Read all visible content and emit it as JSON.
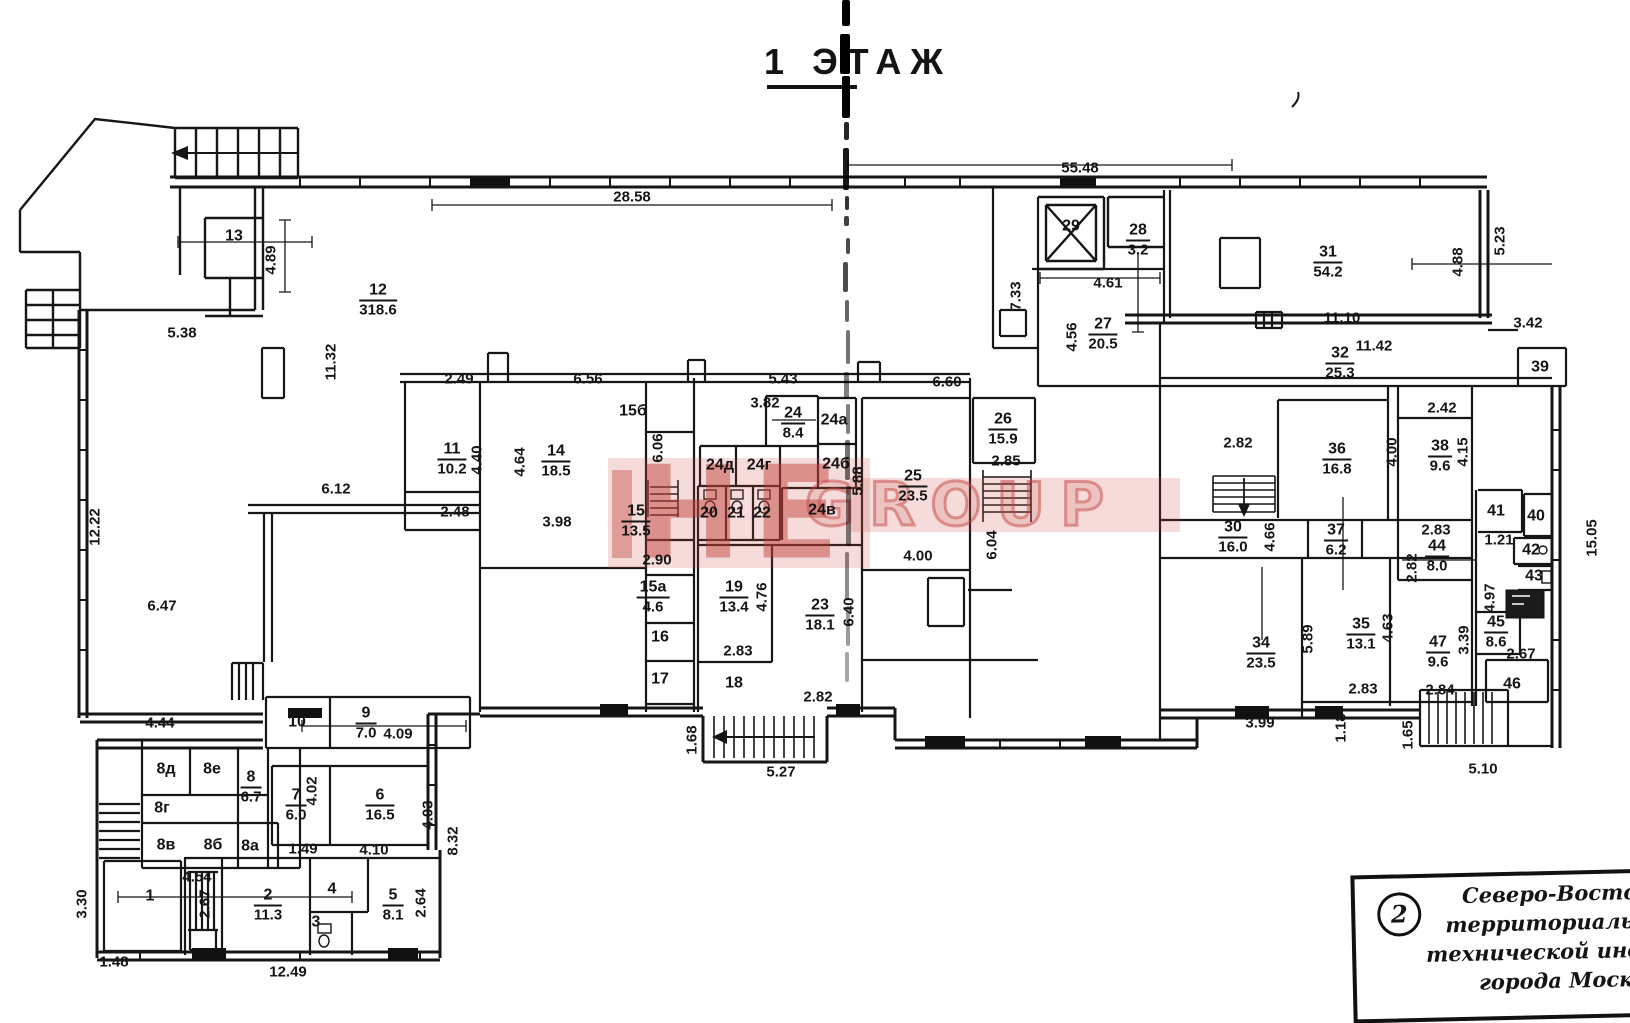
{
  "title": {
    "floor": "1 ЭТАЖ"
  },
  "watermark": {
    "left": "НЕ",
    "right": "GROUP",
    "color": "#c24b44"
  },
  "rooms": [
    {
      "n": "12",
      "a": "318.6",
      "x": 378,
      "y": 300
    },
    {
      "n": "11",
      "a": "10.2",
      "x": 452,
      "y": 459
    },
    {
      "n": "14",
      "a": "18.5",
      "x": 556,
      "y": 461
    },
    {
      "n": "15",
      "a": "13.5",
      "x": 636,
      "y": 521
    },
    {
      "n": "15а",
      "a": "4.6",
      "x": 653,
      "y": 597
    },
    {
      "n": "19",
      "a": "13.4",
      "x": 734,
      "y": 597
    },
    {
      "n": "23",
      "a": "18.1",
      "x": 820,
      "y": 615
    },
    {
      "n": "24",
      "a": "8.4",
      "x": 793,
      "y": 423
    },
    {
      "n": "25",
      "a": "23.5",
      "x": 913,
      "y": 486
    },
    {
      "n": "26",
      "a": "15.9",
      "x": 1003,
      "y": 429
    },
    {
      "n": "27",
      "a": "20.5",
      "x": 1103,
      "y": 334
    },
    {
      "n": "28",
      "a": "3.2",
      "x": 1138,
      "y": 240
    },
    {
      "n": "31",
      "a": "54.2",
      "x": 1328,
      "y": 262
    },
    {
      "n": "32",
      "a": "25.3",
      "x": 1340,
      "y": 363
    },
    {
      "n": "36",
      "a": "16.8",
      "x": 1337,
      "y": 459
    },
    {
      "n": "38",
      "a": "9.6",
      "x": 1440,
      "y": 456
    },
    {
      "n": "30",
      "a": "16.0",
      "x": 1233,
      "y": 537
    },
    {
      "n": "37",
      "a": "6.2",
      "x": 1336,
      "y": 540
    },
    {
      "n": "34",
      "a": "23.5",
      "x": 1261,
      "y": 653
    },
    {
      "n": "35",
      "a": "13.1",
      "x": 1361,
      "y": 634
    },
    {
      "n": "44",
      "a": "8.0",
      "x": 1437,
      "y": 556
    },
    {
      "n": "47",
      "a": "9.6",
      "x": 1438,
      "y": 652
    },
    {
      "n": "45",
      "a": "8.6",
      "x": 1496,
      "y": 632
    },
    {
      "n": "9",
      "a": "7.0",
      "x": 366,
      "y": 723
    },
    {
      "n": "8",
      "a": "6.7",
      "x": 251,
      "y": 787
    },
    {
      "n": "7",
      "a": "6.0",
      "x": 296,
      "y": 805
    },
    {
      "n": "6",
      "a": "16.5",
      "x": 380,
      "y": 805
    },
    {
      "n": "2",
      "a": "11.3",
      "x": 268,
      "y": 905
    },
    {
      "n": "5",
      "a": "8.1",
      "x": 393,
      "y": 905
    },
    {
      "n": "13",
      "x": 234,
      "y": 236
    },
    {
      "n": "29",
      "x": 1071,
      "y": 226
    },
    {
      "n": "15б",
      "x": 633,
      "y": 411
    },
    {
      "n": "20",
      "x": 709,
      "y": 513
    },
    {
      "n": "21",
      "x": 736,
      "y": 513
    },
    {
      "n": "22",
      "x": 762,
      "y": 513
    },
    {
      "n": "24д",
      "x": 720,
      "y": 465
    },
    {
      "n": "24г",
      "x": 759,
      "y": 465
    },
    {
      "n": "24а",
      "x": 834,
      "y": 420
    },
    {
      "n": "24б",
      "x": 836,
      "y": 464
    },
    {
      "n": "24в",
      "x": 822,
      "y": 510
    },
    {
      "n": "10",
      "x": 297,
      "y": 722
    },
    {
      "n": "16",
      "x": 660,
      "y": 637
    },
    {
      "n": "17",
      "x": 660,
      "y": 679
    },
    {
      "n": "18",
      "x": 734,
      "y": 683
    },
    {
      "n": "8д",
      "x": 166,
      "y": 769
    },
    {
      "n": "8е",
      "x": 212,
      "y": 769
    },
    {
      "n": "8г",
      "x": 162,
      "y": 808
    },
    {
      "n": "8в",
      "x": 166,
      "y": 845
    },
    {
      "n": "8б",
      "x": 213,
      "y": 845
    },
    {
      "n": "8а",
      "x": 250,
      "y": 846
    },
    {
      "n": "1",
      "x": 150,
      "y": 896
    },
    {
      "n": "3",
      "x": 316,
      "y": 922
    },
    {
      "n": "4",
      "x": 332,
      "y": 889
    },
    {
      "n": "39",
      "x": 1540,
      "y": 367
    },
    {
      "n": "41",
      "x": 1496,
      "y": 511
    },
    {
      "n": "40",
      "x": 1536,
      "y": 516
    },
    {
      "n": "42",
      "x": 1531,
      "y": 550
    },
    {
      "n": "43",
      "x": 1534,
      "y": 576
    },
    {
      "n": "46",
      "x": 1512,
      "y": 684
    }
  ],
  "dims": [
    {
      "t": "28.58",
      "x": 632,
      "y": 197
    },
    {
      "t": "55.48",
      "x": 1080,
      "y": 168
    },
    {
      "t": "5.38",
      "x": 182,
      "y": 333
    },
    {
      "t": "4.89",
      "x": 271,
      "y": 260,
      "r": -90
    },
    {
      "t": "11.32",
      "x": 331,
      "y": 362,
      "r": -90
    },
    {
      "t": "12.22",
      "x": 95,
      "y": 527,
      "r": -90
    },
    {
      "t": "6.12",
      "x": 336,
      "y": 489
    },
    {
      "t": "6.47",
      "x": 162,
      "y": 606
    },
    {
      "t": "4.44",
      "x": 160,
      "y": 723
    },
    {
      "t": "2.49",
      "x": 459,
      "y": 379
    },
    {
      "t": "6.56",
      "x": 588,
      "y": 379
    },
    {
      "t": "5.43",
      "x": 783,
      "y": 379
    },
    {
      "t": "3.82",
      "x": 765,
      "y": 403
    },
    {
      "t": "6.60",
      "x": 947,
      "y": 382
    },
    {
      "t": "4.40",
      "x": 477,
      "y": 460,
      "r": -90
    },
    {
      "t": "4.64",
      "x": 520,
      "y": 462,
      "r": -90
    },
    {
      "t": "2.48",
      "x": 455,
      "y": 512
    },
    {
      "t": "3.98",
      "x": 557,
      "y": 522
    },
    {
      "t": "6.06",
      "x": 658,
      "y": 448,
      "r": -90
    },
    {
      "t": "2.90",
      "x": 657,
      "y": 560
    },
    {
      "t": "4.76",
      "x": 762,
      "y": 597,
      "r": -90
    },
    {
      "t": "6.40",
      "x": 849,
      "y": 612,
      "r": -90
    },
    {
      "t": "2.83",
      "x": 738,
      "y": 651
    },
    {
      "t": "2.82",
      "x": 818,
      "y": 697
    },
    {
      "t": "1.68",
      "x": 692,
      "y": 740,
      "r": -90
    },
    {
      "t": "5.27",
      "x": 781,
      "y": 772
    },
    {
      "t": "5.88",
      "x": 858,
      "y": 481,
      "r": -90
    },
    {
      "t": "4.00",
      "x": 918,
      "y": 556
    },
    {
      "t": "2.85",
      "x": 1006,
      "y": 461
    },
    {
      "t": "6.04",
      "x": 992,
      "y": 545,
      "r": -90
    },
    {
      "t": "7.33",
      "x": 1016,
      "y": 296,
      "r": -90
    },
    {
      "t": "4.61",
      "x": 1108,
      "y": 283
    },
    {
      "t": "4.56",
      "x": 1072,
      "y": 337,
      "r": -90
    },
    {
      "t": "4.88",
      "x": 1458,
      "y": 262,
      "r": -90
    },
    {
      "t": "5.23",
      "x": 1500,
      "y": 241,
      "r": -90
    },
    {
      "t": "11.10",
      "x": 1342,
      "y": 318
    },
    {
      "t": "3.42",
      "x": 1528,
      "y": 323
    },
    {
      "t": "11.42",
      "x": 1374,
      "y": 346
    },
    {
      "t": "2.42",
      "x": 1442,
      "y": 408
    },
    {
      "t": "2.82",
      "x": 1238,
      "y": 443
    },
    {
      "t": "4.00",
      "x": 1392,
      "y": 452,
      "r": -90
    },
    {
      "t": "4.15",
      "x": 1463,
      "y": 452,
      "r": -90
    },
    {
      "t": "4.66",
      "x": 1270,
      "y": 537,
      "r": -90
    },
    {
      "t": "2.83",
      "x": 1436,
      "y": 530
    },
    {
      "t": "1.21",
      "x": 1499,
      "y": 540
    },
    {
      "t": "2.82",
      "x": 1412,
      "y": 568,
      "r": -90
    },
    {
      "t": "4.97",
      "x": 1490,
      "y": 598,
      "r": -90
    },
    {
      "t": "15.05",
      "x": 1592,
      "y": 538,
      "r": -90
    },
    {
      "t": "5.89",
      "x": 1308,
      "y": 639,
      "r": -90
    },
    {
      "t": "4.63",
      "x": 1388,
      "y": 628,
      "r": -90
    },
    {
      "t": "3.39",
      "x": 1464,
      "y": 640,
      "r": -90
    },
    {
      "t": "2.67",
      "x": 1521,
      "y": 654
    },
    {
      "t": "3.99",
      "x": 1260,
      "y": 723
    },
    {
      "t": "2.83",
      "x": 1363,
      "y": 689
    },
    {
      "t": "2.84",
      "x": 1440,
      "y": 690
    },
    {
      "t": "1.18",
      "x": 1341,
      "y": 728,
      "r": -90
    },
    {
      "t": "1.65",
      "x": 1408,
      "y": 735,
      "r": -90
    },
    {
      "t": "5.10",
      "x": 1483,
      "y": 769
    },
    {
      "t": "4.09",
      "x": 398,
      "y": 734
    },
    {
      "t": "4.02",
      "x": 312,
      "y": 791,
      "r": -90
    },
    {
      "t": "4.03",
      "x": 428,
      "y": 815,
      "r": -90
    },
    {
      "t": "8.32",
      "x": 453,
      "y": 841,
      "r": -90
    },
    {
      "t": "1.49",
      "x": 303,
      "y": 849
    },
    {
      "t": "4.10",
      "x": 374,
      "y": 850
    },
    {
      "t": "4.54",
      "x": 197,
      "y": 877
    },
    {
      "t": "2.67",
      "x": 205,
      "y": 904,
      "r": -90
    },
    {
      "t": "3.30",
      "x": 82,
      "y": 904,
      "r": -90
    },
    {
      "t": "2.64",
      "x": 421,
      "y": 903,
      "r": -90
    },
    {
      "t": "1.48",
      "x": 114,
      "y": 962
    },
    {
      "t": "12.49",
      "x": 288,
      "y": 972
    }
  ],
  "stamp": {
    "num": "2",
    "lines": [
      "Северо-Восточно",
      "территориальное б",
      "технической инвентар",
      "города Москвы"
    ]
  }
}
